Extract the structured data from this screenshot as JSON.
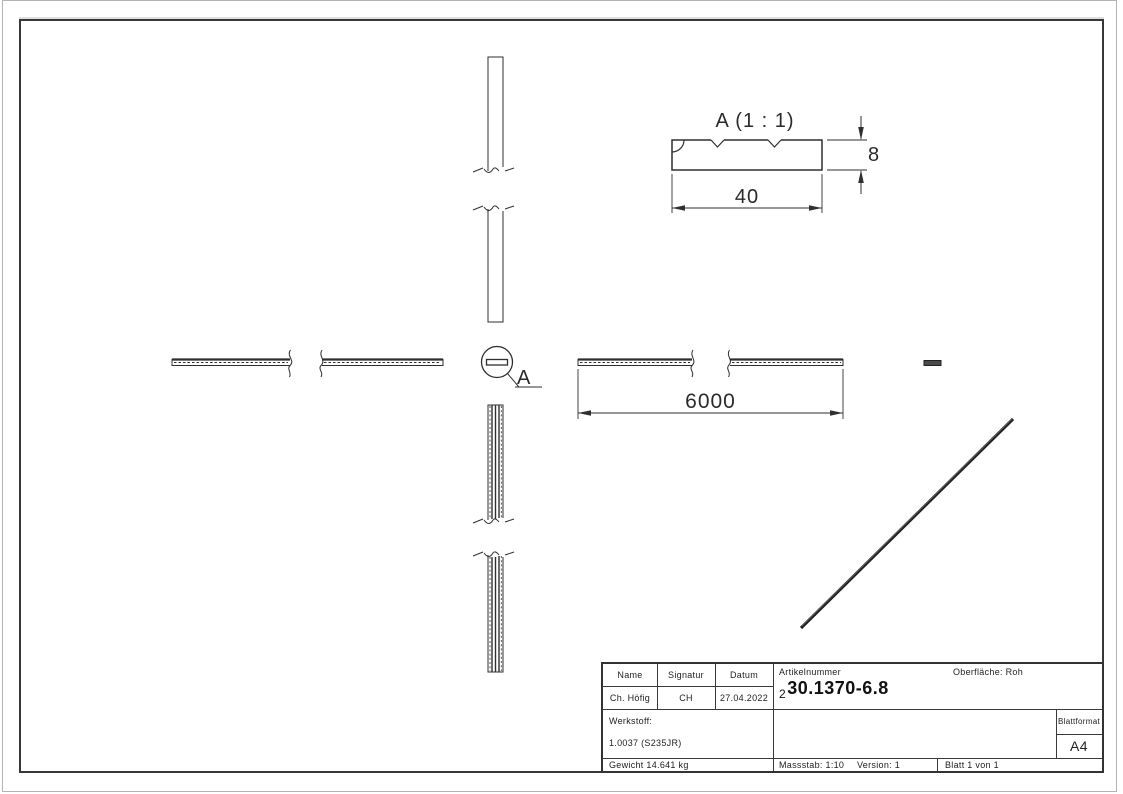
{
  "views": {
    "detail_view": {
      "title": "A (1 : 1)",
      "width_dim": "40",
      "thickness_dim": "8"
    },
    "main_view": {
      "length_dim": "6000"
    },
    "detail_callout": {
      "label": "A"
    }
  },
  "title_block": {
    "col_headers": [
      "Name",
      "Signatur",
      "Datum"
    ],
    "row_values": [
      "Ch. Höfig",
      "CH",
      "27.04.2022"
    ],
    "artikelnummer_label": "Artikelnummer",
    "artikelnummer_prefix": "2",
    "artikelnummer_value": "30.1370-6.8",
    "oberflaeche": "Oberfläche:  Roh",
    "werkstoff_label": "Werkstoff:",
    "werkstoff_value": "1.0037 (S235JR)",
    "gewicht": "Gewicht 14.641 kg",
    "massstab": "Massstab: 1:10",
    "version": "Version: 1",
    "blatt": "Blatt 1 von 1",
    "blattformat_label": "Blattformat",
    "blattformat_value": "A4"
  },
  "colors": {
    "line": "#2f2f2f",
    "frame": "#383838",
    "page_edge": "#b3b3b3"
  }
}
